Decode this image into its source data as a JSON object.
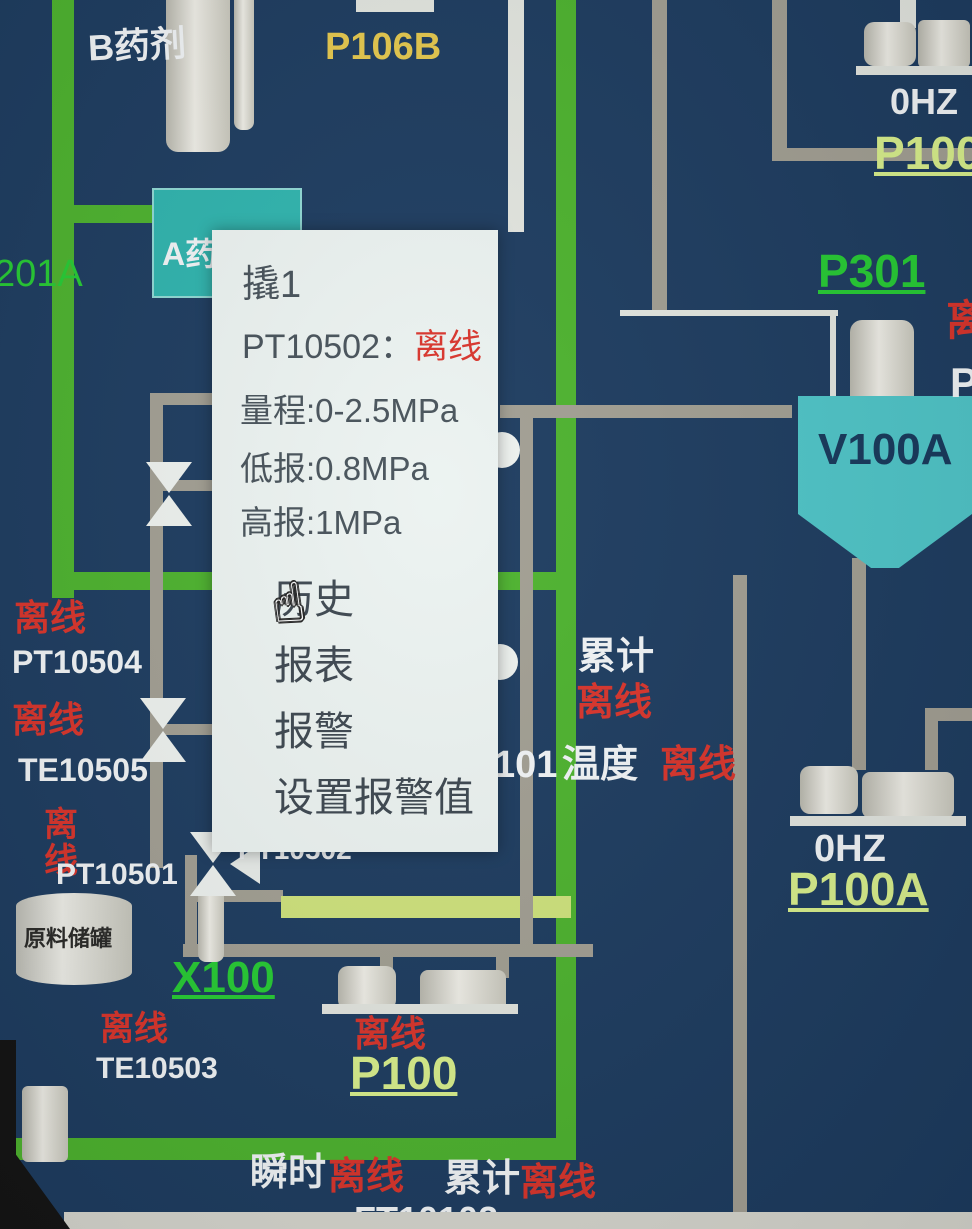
{
  "colors": {
    "background": "#1d3c60",
    "pipe_green": "#4db32e",
    "pipe_gray": "#a29f93",
    "pipe_light_green": "#cfe37c",
    "label_green": "#26cb34",
    "label_yellow": "#e6c94e",
    "label_pale_green": "#d9f08c",
    "offline_red": "#d9342b",
    "popup_bg": "#ecf3f1",
    "popup_text": "#47525a",
    "tank_teal": "#2fb4ae",
    "hopper_cyan": "#4fc6c9"
  },
  "top_area": {
    "b_agent_label": "B药剂",
    "pump_b_tag": "P106B",
    "a_agent_label": "A药剂",
    "line_tag_201a": "201A",
    "top_right_pump": {
      "speed": "0HZ",
      "tag": "P100"
    },
    "p301_tag": "P301",
    "right_edge_partial_red": "离",
    "right_edge_partial_white": "P"
  },
  "popup": {
    "title": "撬1",
    "device_tag": "PT10502",
    "separator": "：",
    "device_status": "离线",
    "range_line": "量程:0-2.5MPa",
    "low_alarm_line": "低报:0.8MPa",
    "high_alarm_line": "高报:1MPa",
    "menu_items": [
      {
        "label": "历史"
      },
      {
        "label": "报表"
      },
      {
        "label": "报警"
      },
      {
        "label": "设置报警值"
      }
    ]
  },
  "left_column": {
    "pt10504": {
      "status": "离线",
      "tag": "PT10504"
    },
    "te10505": {
      "status": "离线",
      "tag": "TE10505"
    },
    "pt10501": {
      "status": "离线",
      "tag": "PT10501"
    },
    "raw_tank_label": "原料储罐",
    "x100_tag": "X100",
    "te10503": {
      "status": "离线",
      "tag": "TE10503"
    }
  },
  "center_area": {
    "pt10502_tag": "PT10502",
    "totalizer": {
      "label": "累计",
      "status": "离线"
    },
    "temperature": {
      "prefix": "101",
      "label": "温度",
      "status": "离线"
    },
    "pump_p100": {
      "status": "离线",
      "tag": "P100"
    }
  },
  "right_area": {
    "hopper_tag": "V100A",
    "pump_p100a": {
      "speed": "0HZ",
      "tag": "P100A"
    }
  },
  "bottom_area": {
    "instantaneous": {
      "label": "瞬时",
      "status": "离线"
    },
    "totalized": {
      "label": "累计",
      "status": "离线"
    },
    "flow_tag": "FT10102"
  },
  "cursor": {
    "icon": "☝"
  }
}
